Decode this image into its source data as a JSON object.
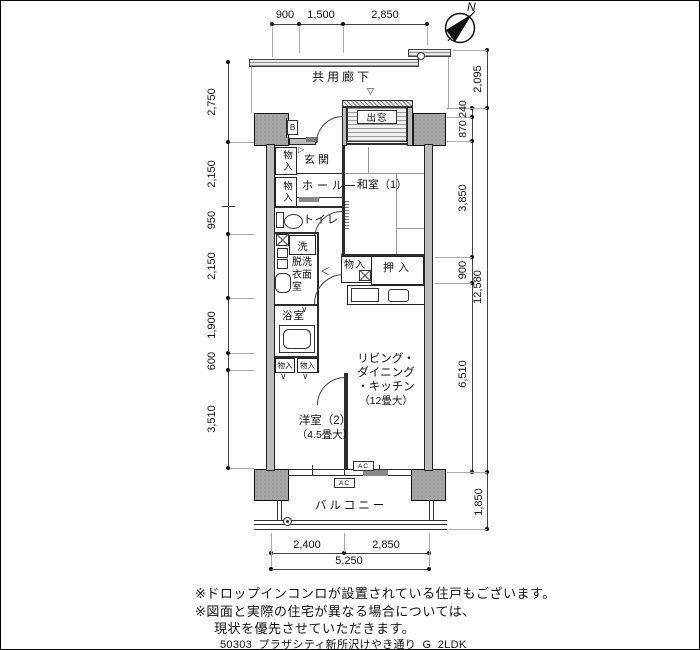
{
  "labels": {
    "corridor": "共用廊下",
    "bay_window": "出窓",
    "bay_marker": "▽",
    "meter_box": "B",
    "entrance": "玄関",
    "step_arrow": "▷",
    "hall": "ホール",
    "storage": "物入",
    "washitsu": "和室（1）",
    "toilet": "トイレ",
    "laundry": "洗",
    "dressing_line1": "脱洗",
    "dressing_line2": "衣面",
    "dressing_line3": "室",
    "oshiire": "押入",
    "bath": "浴室",
    "bath_door_mark": "∨",
    "swing_arrow": "＜",
    "ldk_line1": "リビング・",
    "ldk_line2": "ダイニング",
    "ldk_line3": "・キッチン",
    "ldk_line4": "（12畳大）",
    "yoshitsu_line1": "洋室（2）",
    "yoshitsu_line2": "（4.5畳大）",
    "balcony": "バルコニー",
    "ac": "AC",
    "north": "N"
  },
  "dims": {
    "top": [
      "900",
      "1,500",
      "2,850"
    ],
    "left": [
      "2,750",
      "2,150",
      "950",
      "2,150",
      "1,900",
      "600",
      "3,510"
    ],
    "right_inner": [
      "240",
      "870",
      "3,850",
      "900",
      "6,510"
    ],
    "right_outer": [
      "2,095",
      "12,580",
      "1,850"
    ],
    "bottom": [
      "2,400",
      "2,850",
      "5,250"
    ]
  },
  "notes": {
    "line1": "※ドロップインコンロが設置されている住戸もございます。",
    "line2": "※図面と実際の住宅が異なる場合については、",
    "line3": "現状を優先させていただきます。",
    "filename": "50303_プラザシティ新所沢けやき通り_G_2LDK"
  }
}
